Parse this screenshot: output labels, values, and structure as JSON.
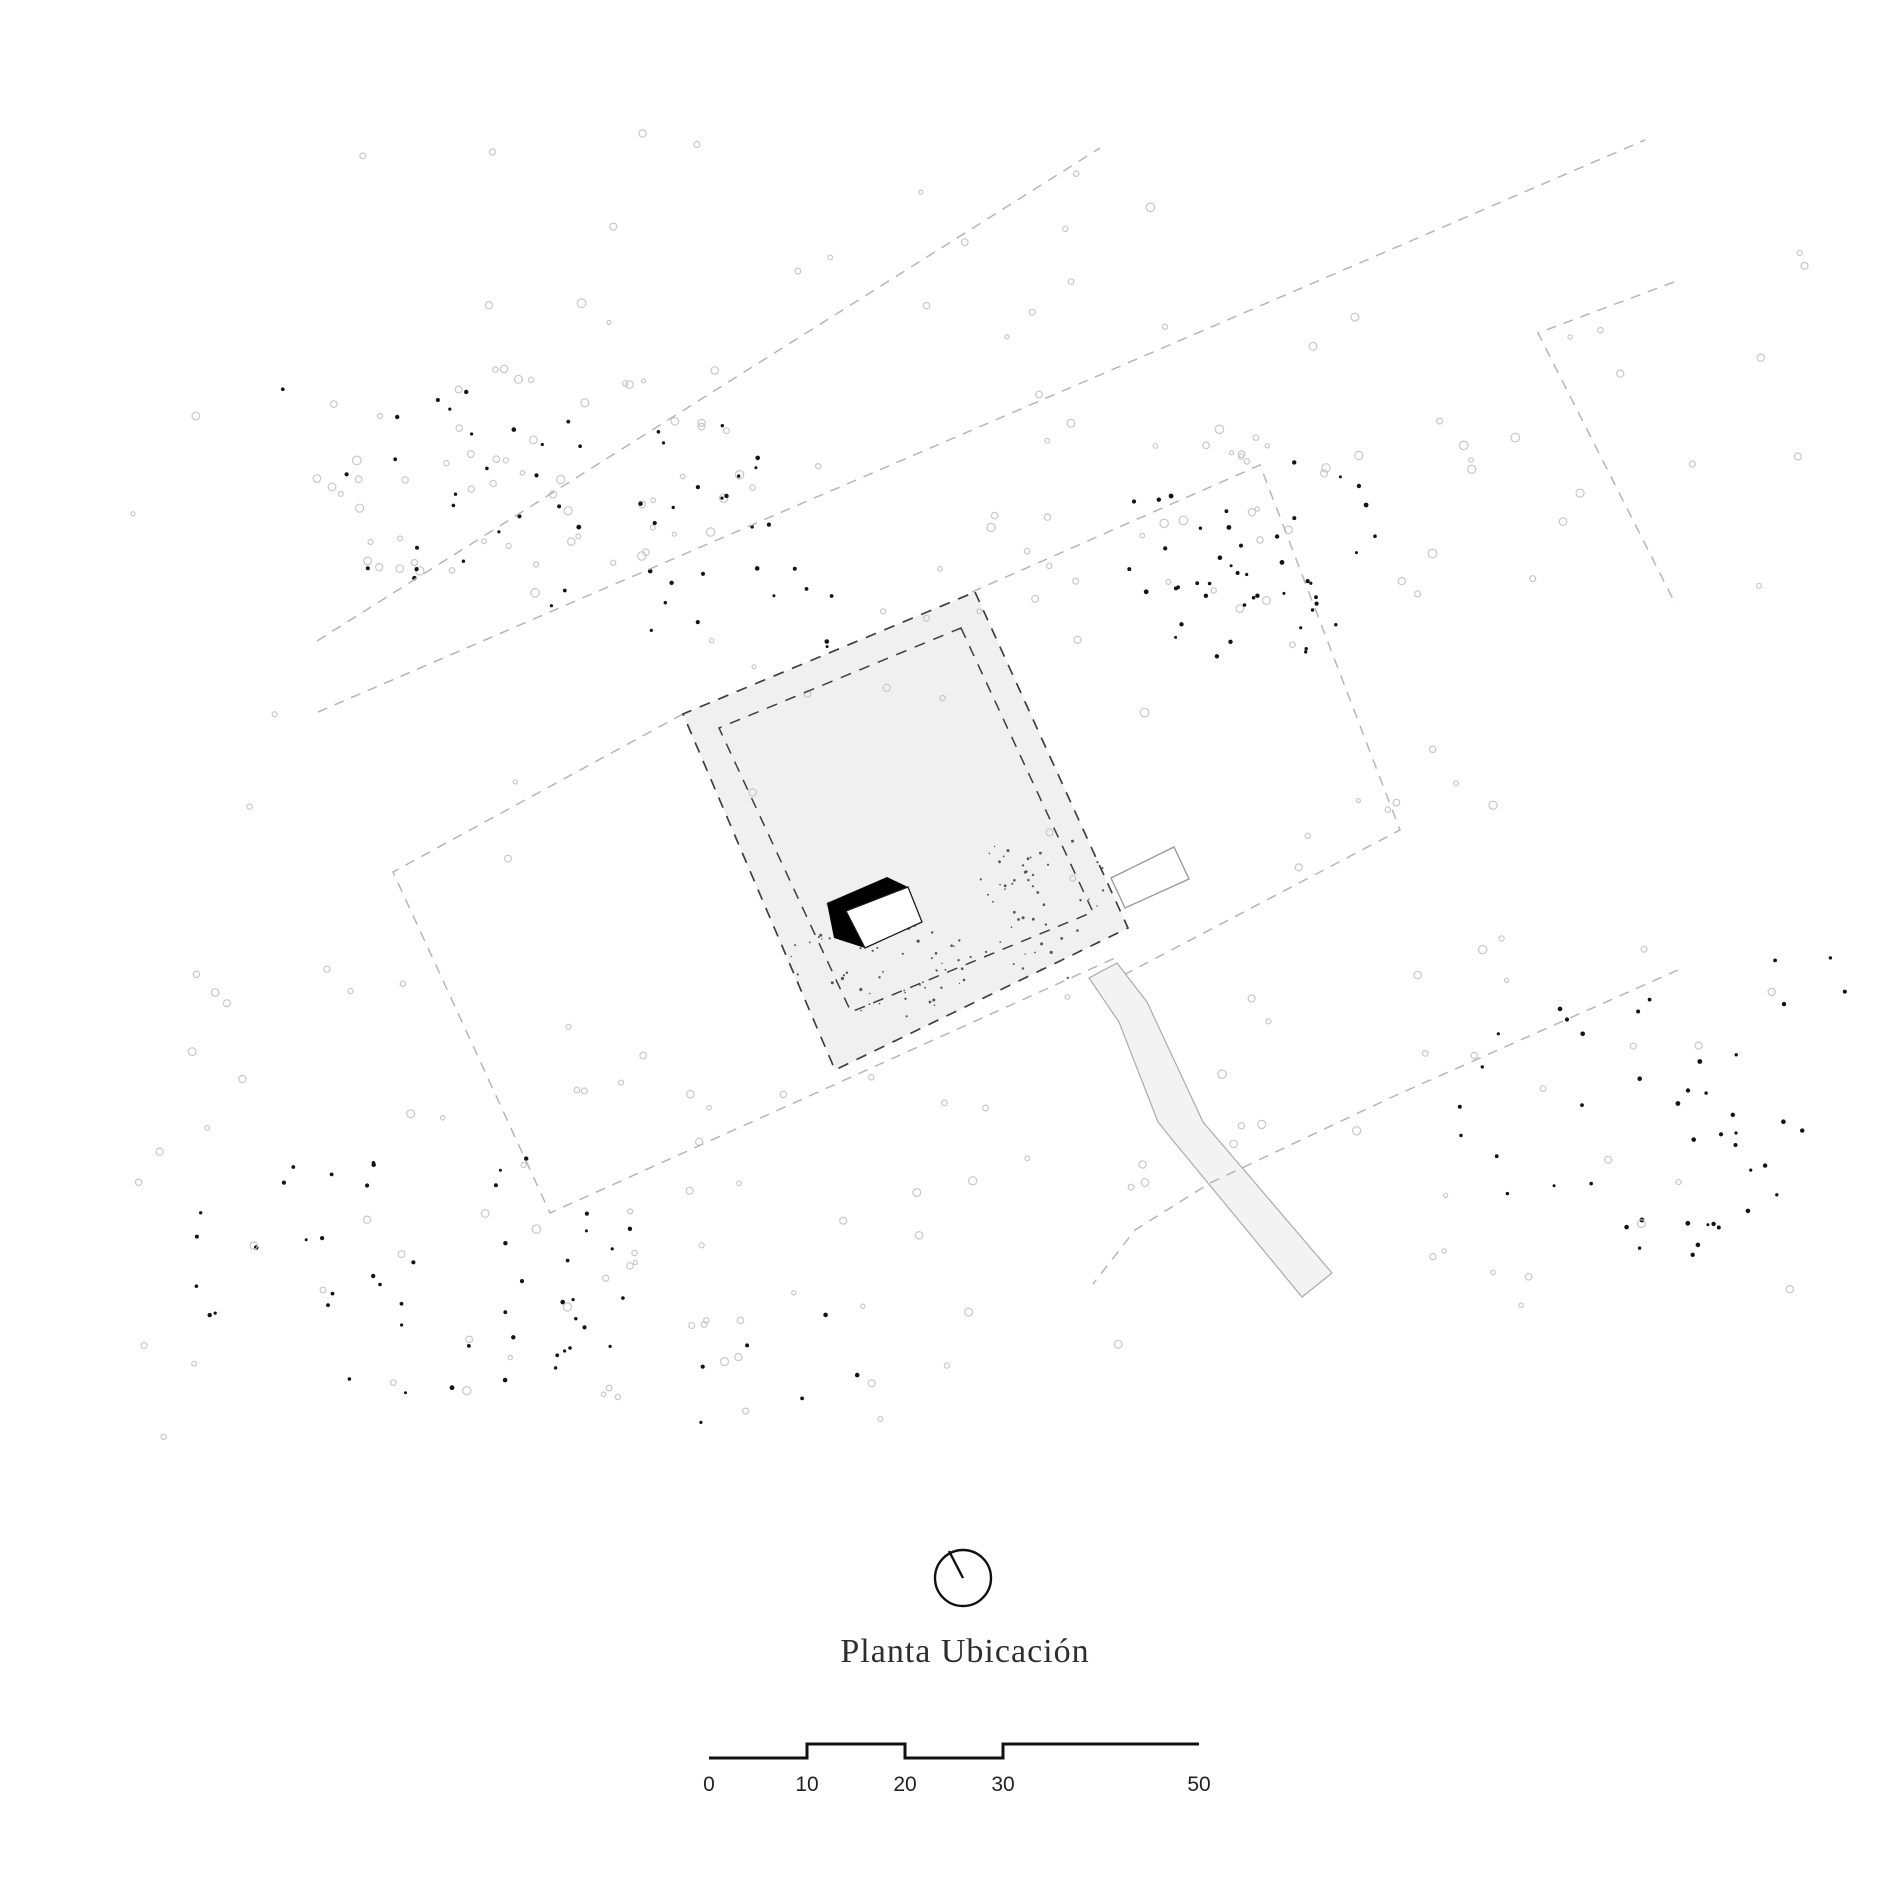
{
  "title": {
    "text": "Planta Ubicación",
    "x": 965,
    "y": 1633
  },
  "colors": {
    "background": "#ffffff",
    "parcel_fill": "#f0f0f0",
    "path_fill": "#f3f3f3",
    "path_stroke": "#ababab",
    "boundary_light": "#b6b6b6",
    "boundary_dark": "#3f3f3f",
    "building_shadow": "#000000",
    "building_roof_fill": "#ffffff",
    "building_roof_stroke": "#1a1a1a",
    "annex_stroke": "#9a9a9a",
    "ink": "#111111",
    "tree_stroke": "#c8c8c8",
    "dot_fill": "#141414",
    "debris_fill": "#555555"
  },
  "north_indicator": {
    "cx": 963,
    "cy": 1578,
    "r": 28,
    "needle_x2": 949,
    "needle_y2": 1551
  },
  "scale_bar": {
    "bar_path": "M709,1758 H807 V1744 H905 V1758 H1003 V1744 H1199",
    "label_y": 1773,
    "ticks": [
      {
        "label": "0",
        "x": 709
      },
      {
        "label": "10",
        "x": 807
      },
      {
        "label": "20",
        "x": 905
      },
      {
        "label": "30",
        "x": 1003
      },
      {
        "label": "50",
        "x": 1199
      }
    ]
  },
  "drawing": {
    "parcel_points": "975,592 1128,928 835,1070 683,714",
    "inner_boundary_points": "961,628 1093,912 851,1012 719,728",
    "path_points": "1117,963 1147,1002 1203,1122 1332,1273 1302,1297 1170,1137 1158,1122 1119,1022 1089,978",
    "annex_points": "1174,847 1189,879 1125,908 1111,878",
    "building_shadow_points": "887,877 908,887 922,922 865,948 834,938 827,903",
    "building_roof_points": "908,887 922,922 865,948 846,911",
    "boundary_lines": [
      {
        "id": "road-line-north-a",
        "points": "317,641 1100,148"
      },
      {
        "id": "road-line-north-b",
        "points": "318,712 1645,140"
      },
      {
        "id": "neighbor-corner-northeast",
        "points": "1674,282 1538,333 1676,605"
      },
      {
        "id": "field-boundary-west",
        "points": "683,714 393,872 550,1213 1115,958"
      },
      {
        "id": "neighbor-boundary-east",
        "points": "972,592 1260,465 1400,830 1118,978"
      }
    ],
    "access_line_points": "1678,970 1390,1098 1210,1183 1135,1230 1093,1284"
  },
  "vegetation": {
    "seed": 911,
    "clusters": [
      {
        "kind": "tree",
        "shape": "ellipse",
        "cx": 540,
        "cy": 480,
        "rx": 250,
        "ry": 115,
        "n": 55
      },
      {
        "kind": "dot",
        "shape": "ellipse",
        "cx": 560,
        "cy": 505,
        "rx": 245,
        "ry": 115,
        "n": 38
      },
      {
        "kind": "dot",
        "shape": "rect",
        "x": 640,
        "y": 560,
        "w": 220,
        "h": 95,
        "n": 12
      },
      {
        "kind": "dot",
        "shape": "rect",
        "x": 250,
        "y": 330,
        "w": 300,
        "h": 120,
        "n": 4
      },
      {
        "kind": "tree",
        "shape": "rect",
        "x": 480,
        "y": 130,
        "w": 800,
        "h": 280,
        "n": 16
      },
      {
        "kind": "tree",
        "shape": "rect",
        "x": 850,
        "y": 400,
        "w": 420,
        "h": 220,
        "n": 22
      },
      {
        "kind": "dot",
        "shape": "ellipse",
        "cx": 1255,
        "cy": 560,
        "rx": 150,
        "ry": 105,
        "n": 45
      },
      {
        "kind": "tree",
        "shape": "ellipse",
        "cx": 1270,
        "cy": 560,
        "rx": 160,
        "ry": 110,
        "n": 14
      },
      {
        "kind": "tree",
        "shape": "rect",
        "x": 1300,
        "y": 200,
        "w": 520,
        "h": 650,
        "n": 24
      },
      {
        "kind": "dot",
        "shape": "ellipse",
        "cx": 1630,
        "cy": 1130,
        "rx": 175,
        "ry": 150,
        "n": 40
      },
      {
        "kind": "tree",
        "shape": "rect",
        "x": 1400,
        "y": 900,
        "w": 420,
        "h": 420,
        "n": 20
      },
      {
        "kind": "dot",
        "shape": "rect",
        "x": 1700,
        "y": 940,
        "w": 150,
        "h": 70,
        "n": 4
      },
      {
        "kind": "dot",
        "shape": "ellipse",
        "cx": 405,
        "cy": 1265,
        "rx": 235,
        "ry": 135,
        "n": 45
      },
      {
        "kind": "tree",
        "shape": "rect",
        "x": 140,
        "y": 980,
        "w": 620,
        "h": 440,
        "n": 30
      },
      {
        "kind": "tree",
        "shape": "rect",
        "x": 560,
        "y": 1050,
        "w": 450,
        "h": 380,
        "n": 28
      },
      {
        "kind": "dot",
        "shape": "rect",
        "x": 560,
        "y": 1270,
        "w": 340,
        "h": 170,
        "n": 9
      },
      {
        "kind": "debris",
        "shape": "ellipse",
        "cx": 878,
        "cy": 962,
        "rx": 95,
        "ry": 58,
        "n": 60
      },
      {
        "kind": "debris",
        "shape": "ellipse",
        "cx": 1040,
        "cy": 905,
        "rx": 72,
        "ry": 80,
        "n": 52
      },
      {
        "kind": "tree",
        "shape": "rect",
        "x": 700,
        "y": 610,
        "w": 380,
        "h": 420,
        "n": 12
      },
      {
        "kind": "tree",
        "shape": "rect",
        "x": 1130,
        "y": 990,
        "w": 230,
        "h": 220,
        "n": 12
      },
      {
        "kind": "tree",
        "shape": "rect",
        "x": 120,
        "y": 140,
        "w": 1680,
        "h": 1320,
        "n": 40
      }
    ]
  }
}
